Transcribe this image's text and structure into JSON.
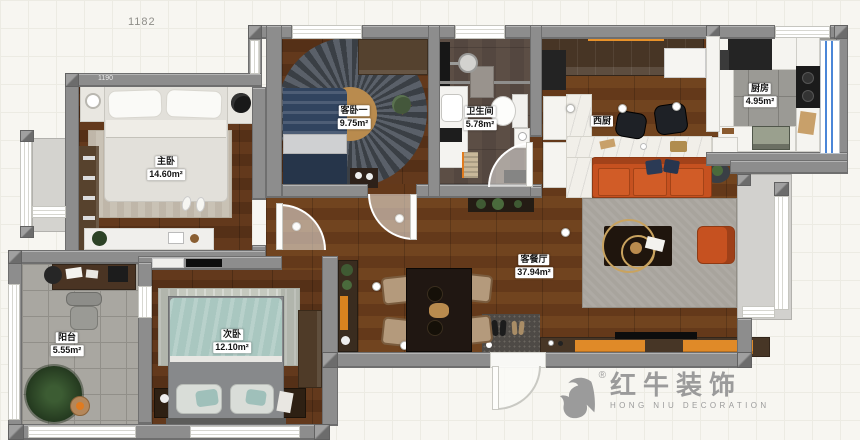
{
  "plan": {
    "dimension_top": "1182",
    "dimension_wall": "1190",
    "rooms": {
      "master": {
        "name": "主卧",
        "area": "14.60m²"
      },
      "guest": {
        "name": "客卧一",
        "area": "9.75m²"
      },
      "bathroom": {
        "name": "卫生间",
        "area": "5.78m²"
      },
      "west_kitchen": {
        "name": "西厨",
        "area": ""
      },
      "kitchen": {
        "name": "厨房",
        "area": "4.95m²"
      },
      "living": {
        "name": "客餐厅",
        "area": "37.94m²"
      },
      "second": {
        "name": "次卧",
        "area": "12.10m²"
      },
      "balcony": {
        "name": "阳台",
        "area": "5.55m²"
      }
    }
  },
  "logo": {
    "brand_cn": "红牛装饰",
    "brand_en": "HONG NIU DECORATION",
    "registered": "®"
  },
  "colors": {
    "wall": "#8d8d8d",
    "wood_living": "#6f421f",
    "wood_master": "#5f3a20",
    "sofa_orange": "#c65120",
    "cabinet_orange": "#e8922a",
    "teal_bed": "#a9c7c0",
    "navy_bed": "#31445f",
    "window_blue": "#4a86d8",
    "rug_gray": "#a6a29b",
    "logo_gray": "#9b9b9b"
  }
}
